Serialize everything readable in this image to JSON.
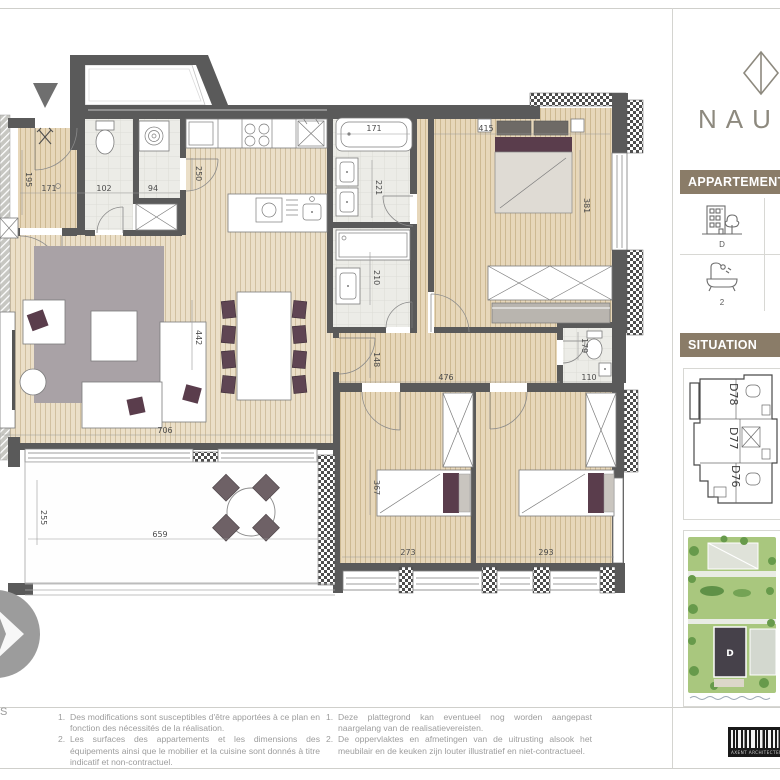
{
  "brand": {
    "logo_text": "NAU"
  },
  "sidebar": {
    "apartment_header": "APPARTEMENT D",
    "info_cells": [
      {
        "icon": "building-tree-icon",
        "caption": "D"
      },
      {
        "icon": "bathtub-icon",
        "caption": "2"
      }
    ],
    "situation_header": "SITUATION",
    "situation_units": [
      "D78",
      "D77",
      "D76"
    ],
    "siteplan_building_label": "D",
    "architect_logo_text": "AXENT ARCHITECTEN"
  },
  "plan": {
    "compass_letter": "S",
    "dims": {
      "hall_w": "171",
      "hall_h": "195",
      "wc": "102",
      "laundry": "94",
      "kitchen_door": "250",
      "bath1_tub": "171",
      "bath1_d": "221",
      "bath2_d": "210",
      "master_w": "415",
      "master_d": "381",
      "wc2_d": "179",
      "wc2_w": "110",
      "hall_len": "476",
      "hall_wid": "148",
      "bed2_d": "367",
      "bed2_w": "273",
      "bed3_w": "293",
      "living_d": "442",
      "living_w": "706",
      "terr_d": "255",
      "terr_w": "659"
    }
  },
  "footer": {
    "fr": [
      {
        "num": "1.",
        "text": "Des modifications sont susceptibles d'être apportées à ce plan en fonction des nécessités de la réalisation."
      },
      {
        "num": "2.",
        "text": "Les surfaces des appartements et les dimensions des équipements ainsi que le mobilier et la cuisine sont donnés à titre indicatif et non-contractuel."
      }
    ],
    "nl": [
      {
        "num": "1.",
        "text": "Deze plattegrond kan eventueel nog worden aangepast naargelang van de realisatievereisten."
      },
      {
        "num": "2.",
        "text": "De oppervlaktes en afmetingen van de uitrusting alsook het meubilair en de keuken zijn louter illustratief en niet-contractueel."
      }
    ]
  },
  "colors": {
    "accent_taupe": "#8a7c68",
    "wall": "#5a5a5a",
    "wood_light": "#ebdfc8",
    "wood_tan": "#e7d7ba",
    "accent_purple": "#5a3d4c",
    "site_green": "#a9c77e"
  }
}
